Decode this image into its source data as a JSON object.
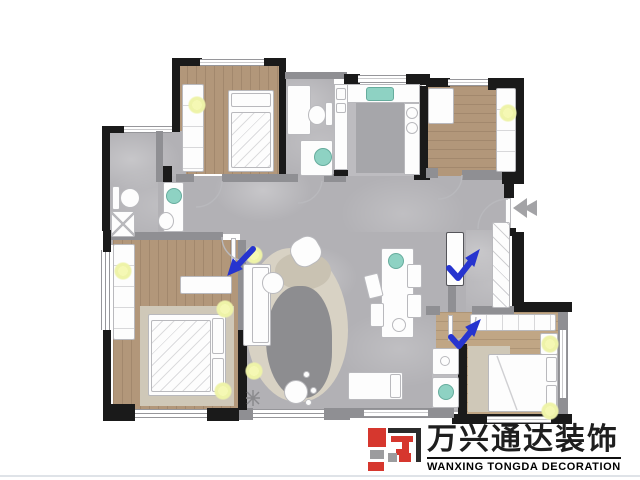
{
  "image": {
    "description": "Rendered top-view interior floor plan of a multi-bedroom apartment with three hand-drawn blue checkmark annotations and an entrance arrow",
    "background": "#ffffff"
  },
  "branding": {
    "company_name_zh": "万兴通达装饰",
    "company_name_en": "WANXING TONGDA DECORATION"
  },
  "annotations": {
    "blue_checkmark_count": "3",
    "entrance_arrow": "gray arrow pointing left into entry door"
  },
  "colors": {
    "wall": "#1a1a1a",
    "wall_gray": "#8f8f93",
    "island": "#a6a6aa",
    "tile": "#b2b1b5",
    "tile_light": "#bdbcc0",
    "wood": "#b2977a",
    "wood_light": "#c0a685",
    "furniture": "#fdfdfd",
    "furniture_border": "#b9b9bd",
    "teal": "#8ed2c3",
    "teal_border": "#66ac9d",
    "glow": "#eef3a8",
    "rug": "#d8d2c4",
    "rug_blob": "#8d8d90",
    "bed_rug": "#cfc8b8",
    "arrow_blue": "#2634cf",
    "entry_arrow": "#a3a3a6",
    "logo_red": "#d6372e",
    "logo_dark": "#2b2b2b",
    "logo_gray": "#9c9c9e",
    "text_dark": "#1e1e1e",
    "page_line": "#dfe3e8"
  }
}
